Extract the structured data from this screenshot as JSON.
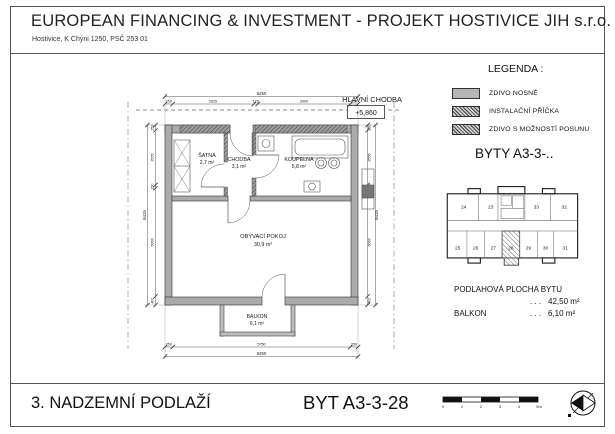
{
  "header": {
    "title": "EUROPEAN FINANCING & INVESTMENT - PROJEKT HOSTIVICE JIH s.r.o.",
    "address": "Hostivice, K Chýni 1250, PSČ 253 01"
  },
  "legend": {
    "title": "LEGENDA :",
    "items": [
      {
        "label": "ZDIVO NOSNÉ",
        "swatch": "solid-gray"
      },
      {
        "label": "INSTALAČNÍ PŘÍČKA",
        "swatch": "diagonal-hatch"
      },
      {
        "label": "ZDIVO S MOŽNOSTÍ POSUNU",
        "swatch": "cross-hatch"
      }
    ]
  },
  "unit_group_title": "BYTY  A3-3-..",
  "key_plan": {
    "units_top": [
      "24",
      "23",
      "33",
      "32"
    ],
    "units_bottom": [
      "25",
      "26",
      "27",
      "28",
      "29",
      "30",
      "31"
    ],
    "highlighted_unit": "28"
  },
  "areas": {
    "title": "PODLAHOVÁ PLOCHA BYTU",
    "rows": [
      {
        "label": "",
        "dots": ". . .",
        "value": "42,50 m²"
      },
      {
        "label": "BALKON",
        "dots": ". . .",
        "value": "6,10 m²"
      }
    ]
  },
  "plan": {
    "corridor_label": "HLAVNÍ CHODBA",
    "corridor_elevation": "+5,860",
    "rooms": [
      {
        "name": "ŠATNA",
        "area": "2,7 m²"
      },
      {
        "name": "CHODBA",
        "area": "3,1 m²"
      },
      {
        "name": "KOUPELNA",
        "area": "5,8 m²"
      },
      {
        "name": "OBÝVACÍ POKOJ",
        "area": "30,9 m²"
      },
      {
        "name": "BALKON",
        "area": "6,1 m²"
      }
    ],
    "dims": {
      "top_total": "6250",
      "top_segments": [
        "250",
        "2625",
        "125",
        "3000",
        "250"
      ],
      "bottom_total": "6250",
      "bottom_segments": [
        "250",
        "5750",
        "250"
      ],
      "side_total": "8415",
      "side_segments": [
        "250",
        "2555",
        "150",
        "5060",
        "400"
      ]
    }
  },
  "footer": {
    "floor_label": "3. NADZEMNÍ PODLAŽÍ",
    "unit_label": "BYT  A3-3-28",
    "scale_ticks": [
      "0",
      "1",
      "2",
      "3",
      "4",
      "5m"
    ]
  },
  "colors": {
    "wall_gray": "#ababab",
    "line": "#1a1a1a"
  }
}
